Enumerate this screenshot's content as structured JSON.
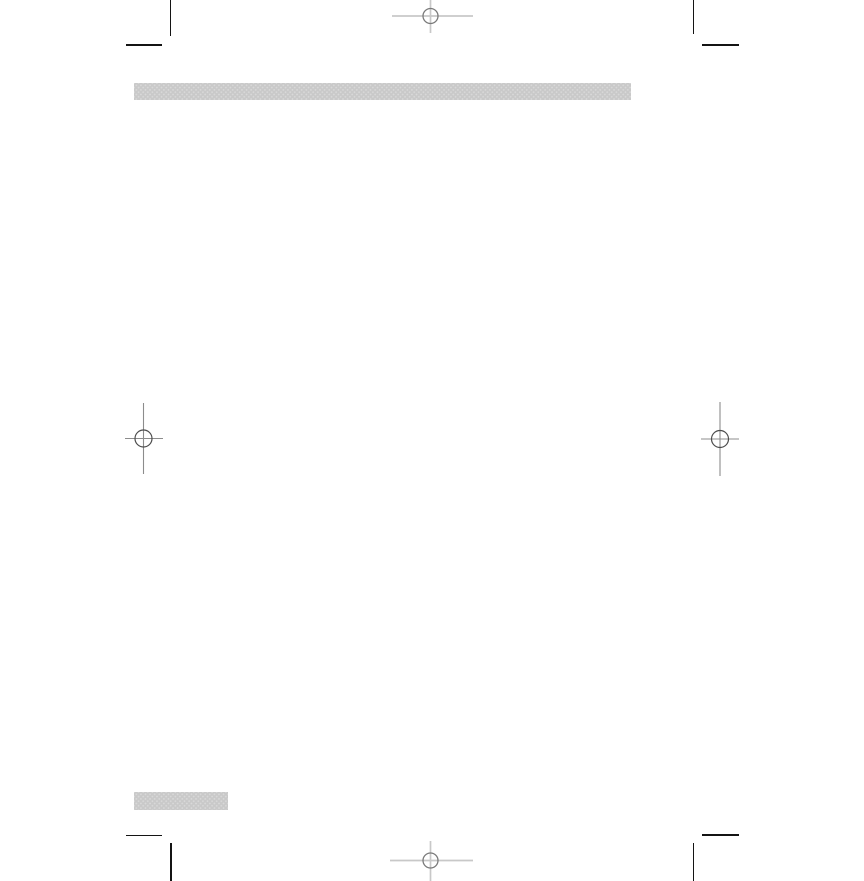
{
  "page": {
    "kind": "blank-print-proof-page"
  },
  "colors": {
    "page-bg": "#ffffff",
    "bar-fill": "#c9c9c9",
    "bar-dot": "#d9d9d9",
    "crop-mark": "#141414",
    "reg-line-light": "#c8c8c8",
    "reg-circle-light": "#7a7a7a",
    "reg-line-dark": "#8c8c8c",
    "reg-circle-dark": "#4d4d4d"
  },
  "crop_marks": [
    "top-left",
    "top-right",
    "bottom-left",
    "bottom-right"
  ],
  "registration_marks": [
    {
      "id": "top-center",
      "icon": "registration-mark-icon",
      "style": "light"
    },
    {
      "id": "left-middle",
      "icon": "registration-mark-icon",
      "style": "dark"
    },
    {
      "id": "right-middle",
      "icon": "registration-mark-icon",
      "style": "dark"
    },
    {
      "id": "bottom-center",
      "icon": "registration-mark-icon",
      "style": "light"
    }
  ],
  "placeholder_bars": [
    {
      "id": "header-bar",
      "texture": "halftone-dots"
    },
    {
      "id": "footer-bar",
      "texture": "halftone-dots"
    }
  ]
}
